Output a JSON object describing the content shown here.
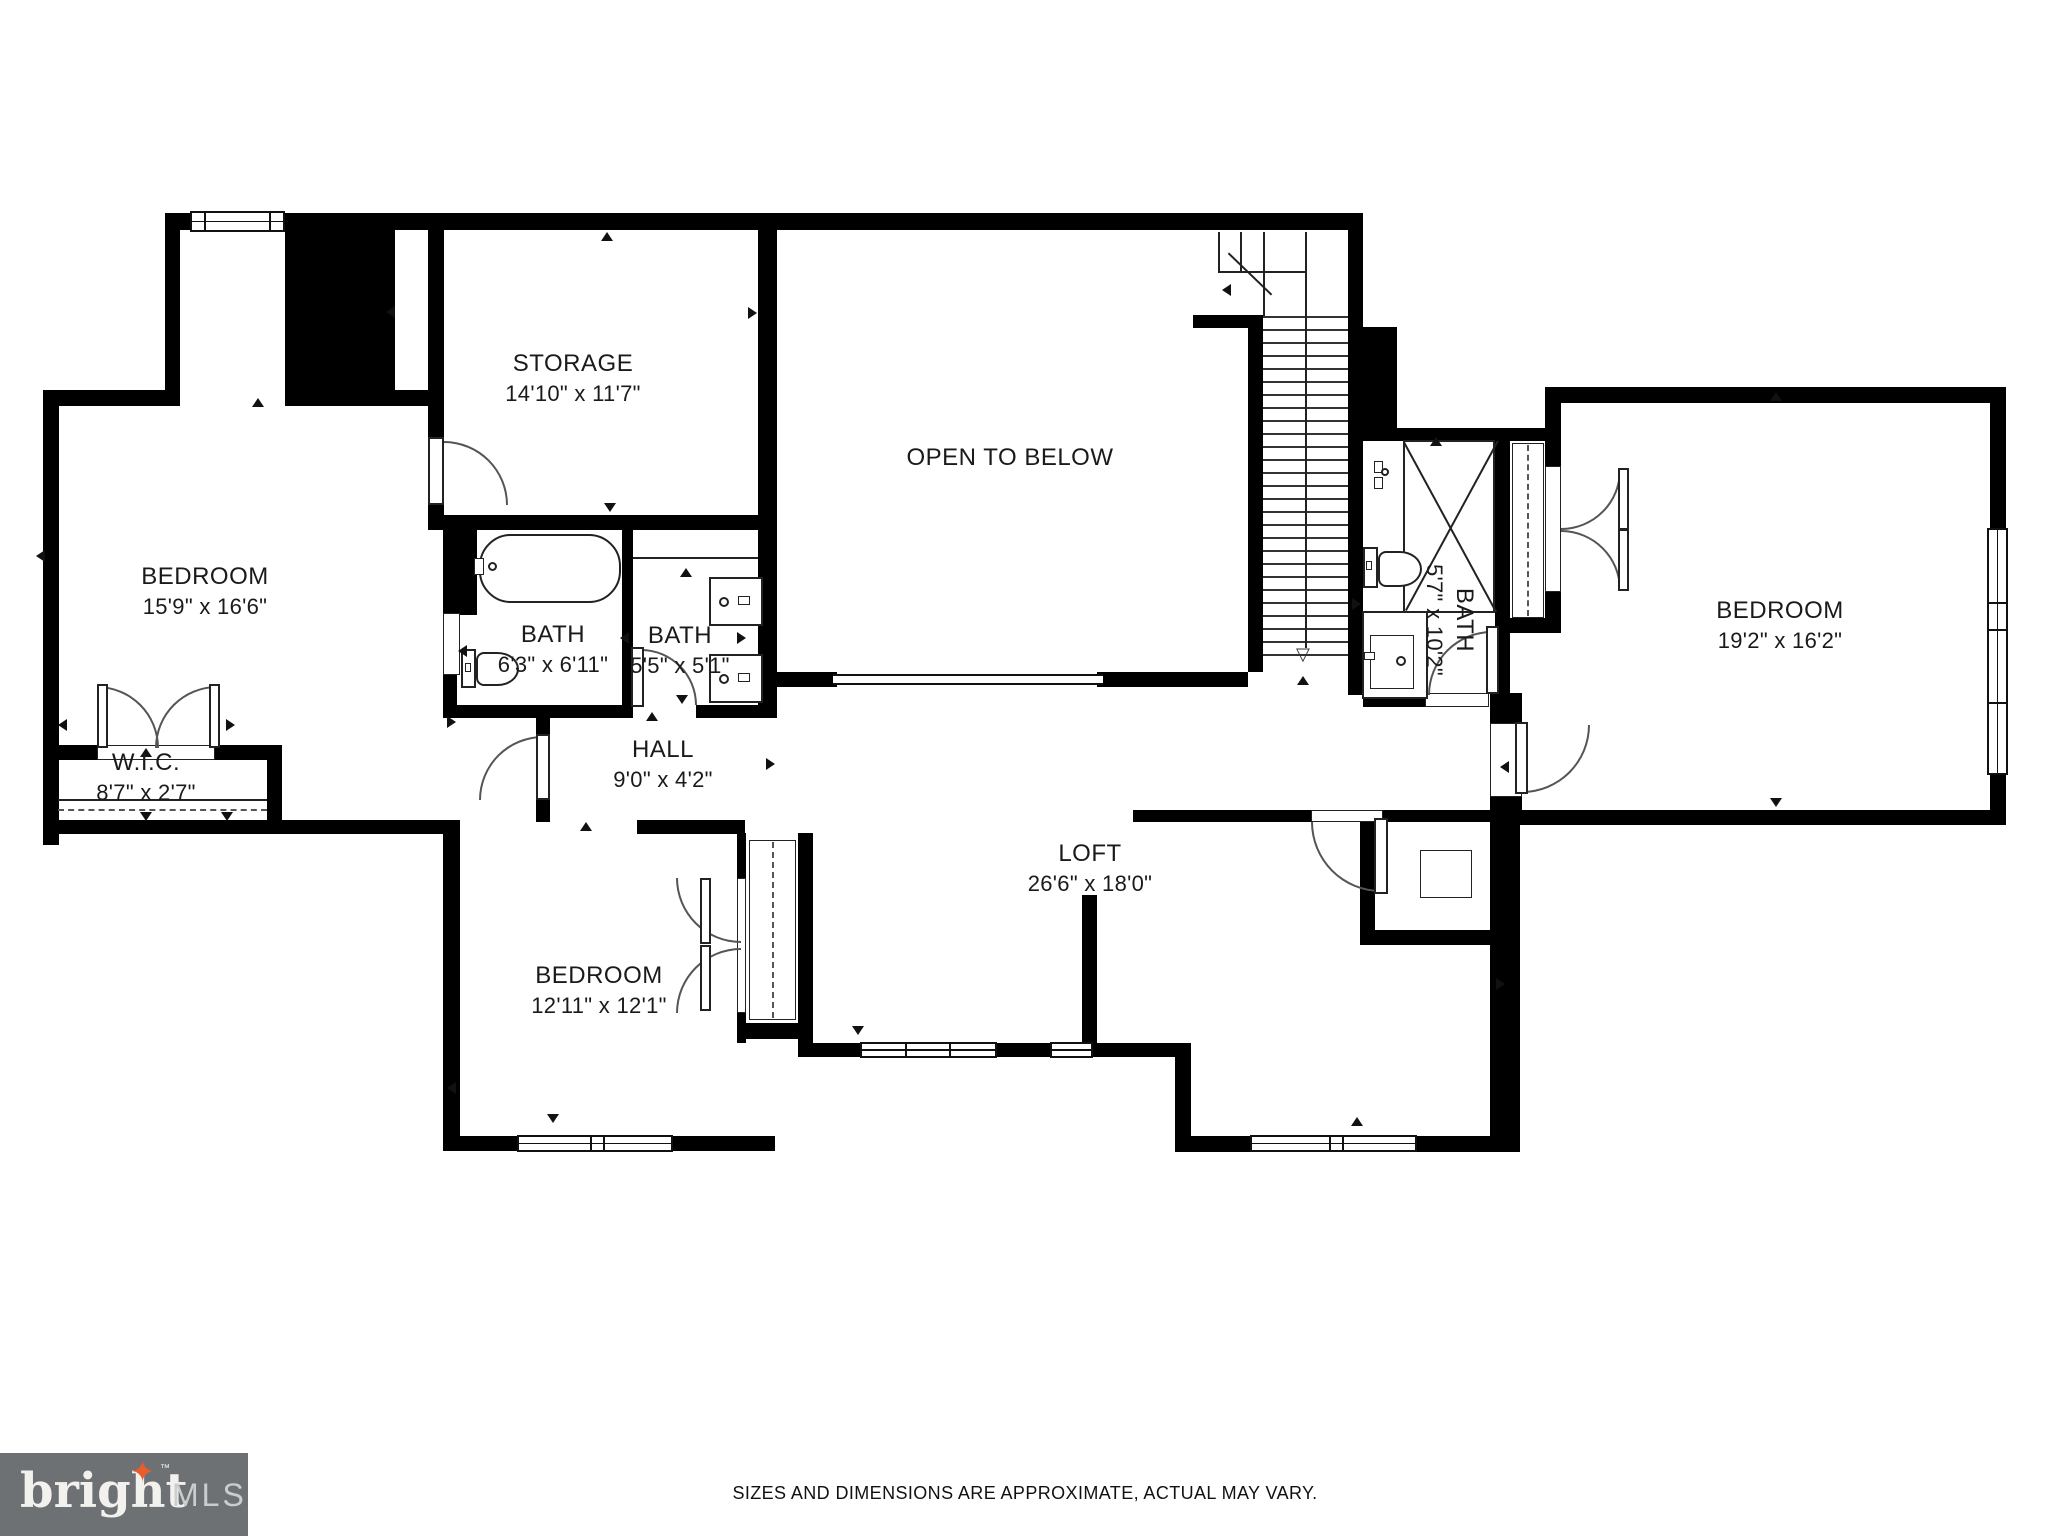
{
  "rooms": {
    "bedroom_left": {
      "name": "BEDROOM",
      "dims": "15'9\" x 16'6\""
    },
    "storage": {
      "name": "STORAGE",
      "dims": "14'10\" x 11'7\""
    },
    "open_to_below": {
      "name": "OPEN TO BELOW"
    },
    "bath_left": {
      "name": "BATH",
      "dims": "6'3\" x 6'11\""
    },
    "bath_middle": {
      "name": "BATH",
      "dims": "5'5\" x 5'1\""
    },
    "bath_right": {
      "name": "BATH",
      "dims": "5'7\" x 10'2\""
    },
    "wic": {
      "name": "W.I.C.",
      "dims": "8'7\" x 2'7\""
    },
    "hall": {
      "name": "HALL",
      "dims": "9'0\" x 4'2\""
    },
    "bedroom_bottom": {
      "name": "BEDROOM",
      "dims": "12'11\" x 12'1\""
    },
    "loft": {
      "name": "LOFT",
      "dims": "26'6\" x 18'0\""
    },
    "bedroom_right": {
      "name": "BEDROOM",
      "dims": "19'2\" x 16'2\""
    }
  },
  "footer": {
    "disclaimer": "SIZES AND DIMENSIONS ARE APPROXIMATE, ACTUAL MAY VARY."
  },
  "logo": {
    "brand": "bright",
    "star": "✦",
    "tm": "™",
    "suffix": "MLS",
    "accent_color": "#e85c2e",
    "bg_color": "#6d7174",
    "brand_color": "#f2f1ee",
    "suffix_color": "#c9cdce"
  }
}
